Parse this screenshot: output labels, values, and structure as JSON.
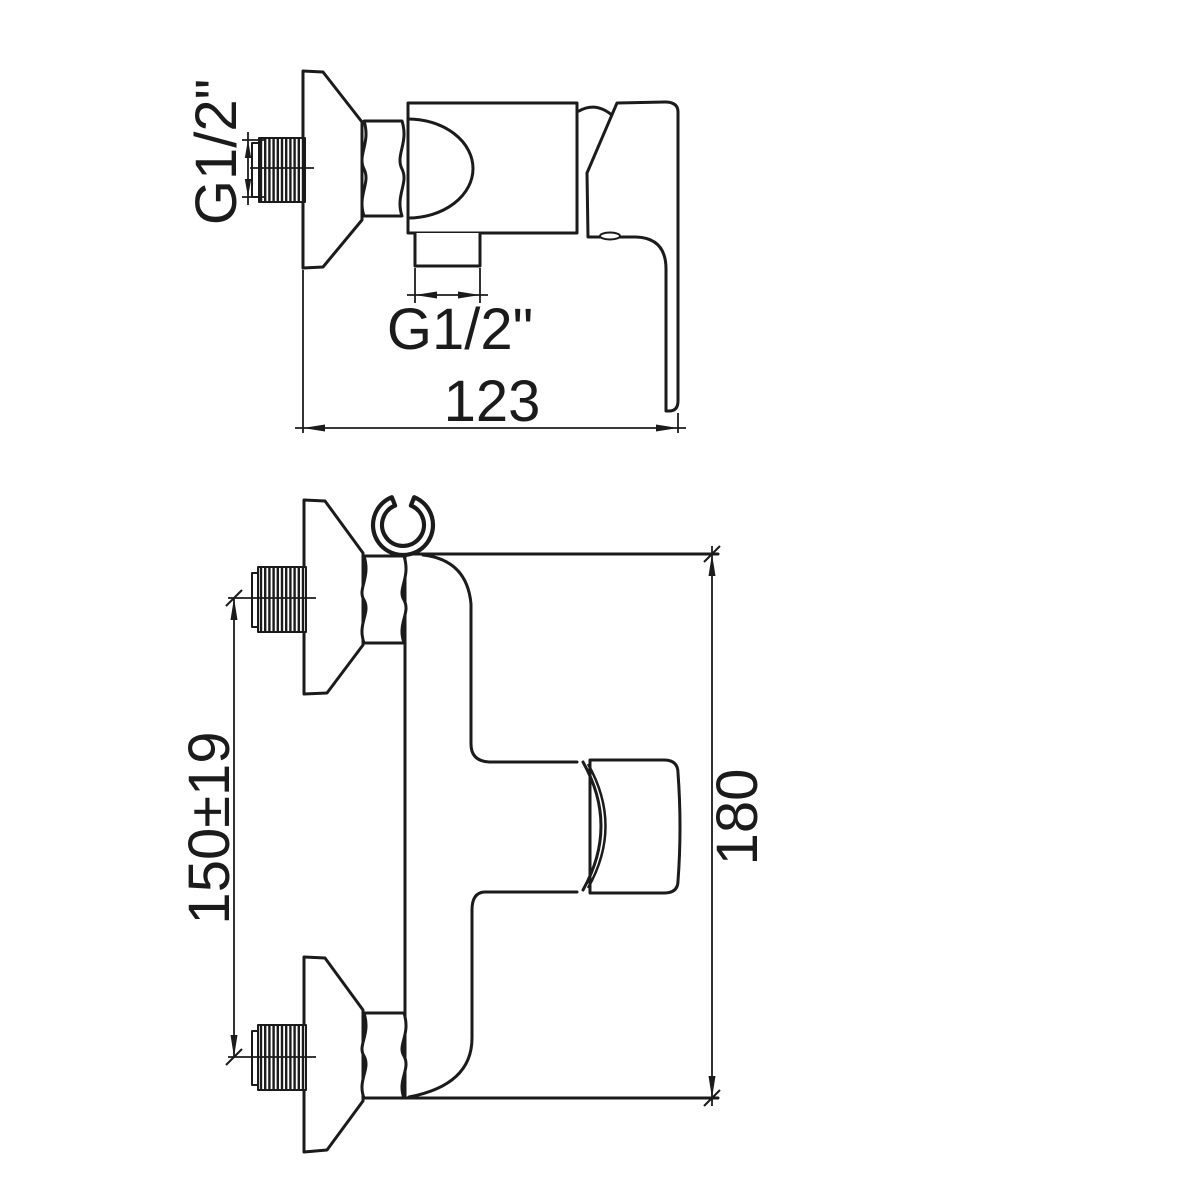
{
  "drawing": {
    "background_color": "#ffffff",
    "line_color": "#1b1b1b",
    "side_view": {
      "inlet_thread_label": "G1/2\"",
      "outlet_thread_label": "G1/2\"",
      "width_dimension": "123"
    },
    "front_view": {
      "inlet_spacing_dimension": "150±19",
      "height_dimension": "180"
    }
  }
}
